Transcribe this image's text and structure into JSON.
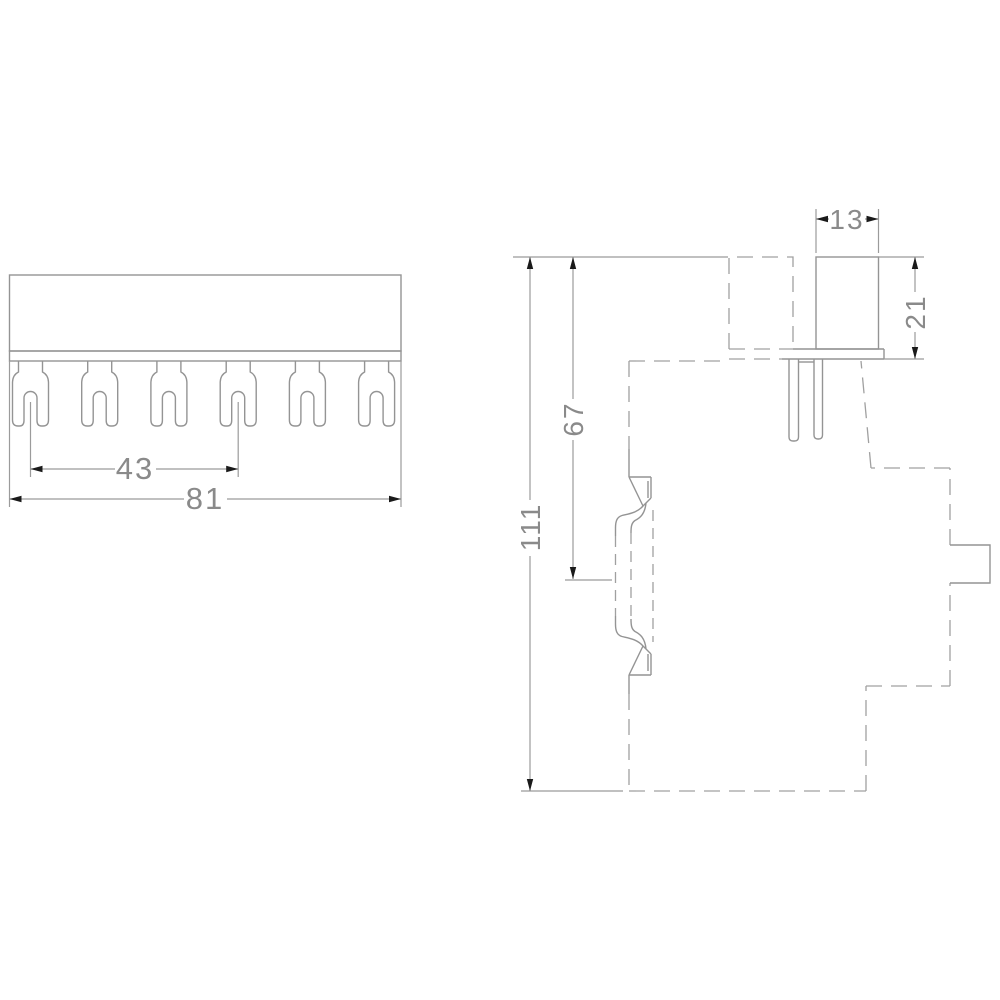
{
  "drawing": {
    "type": "technical-dimension-drawing",
    "description": "Two-view CAD drawing of a fork-type busbar: front view with 6 fork terminals and side view with phantom outline of breaker device",
    "colors": {
      "background": "#ffffff",
      "line": "#9b9b9b",
      "phantom_line": "#a0a0a0",
      "arrowhead": "#1a1a1a",
      "text": "#8a8a8a"
    },
    "front_view": {
      "fork_count": 6,
      "dimensions": {
        "pin_spacing": "43",
        "total_width": "81"
      }
    },
    "side_view": {
      "dimensions": {
        "cap_width": "13",
        "cap_height": "21",
        "top_to_rail": "67",
        "total_height": "111"
      }
    }
  }
}
